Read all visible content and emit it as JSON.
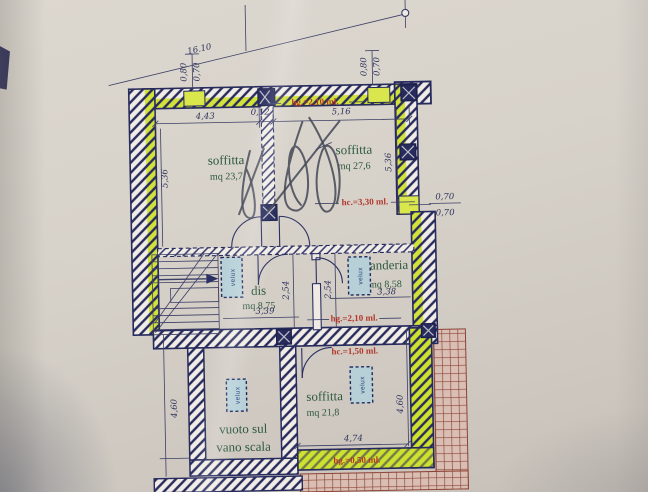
{
  "dims": {
    "overall": "16.10",
    "win_left": [
      "0,80",
      "0,70"
    ],
    "win_right": [
      "0,80",
      "0,70"
    ],
    "top_row": [
      "4,43",
      "0,12",
      "5,16"
    ],
    "left_height": "5,36",
    "right_height": "5,36",
    "right_step": [
      "0,70",
      "0,70"
    ],
    "mid_heights": [
      "2,54",
      "2,54"
    ],
    "dis_width": "3,39",
    "lav_width": "3,38",
    "bottom_left_height": "4,60",
    "bottom_right_height": "4,60",
    "bottom_width": "4,74"
  },
  "rooms": {
    "soffitta_nw": {
      "name": "soffitta",
      "area": "mq 23,7"
    },
    "soffitta_ne": {
      "name": "soffitta",
      "area": "mq 27,6"
    },
    "dis": {
      "name": "dis",
      "area": "mq 8,75"
    },
    "lavanderia": {
      "name": "lavanderia",
      "area": "mq 8,58"
    },
    "soffitta_s": {
      "name": "soffitta",
      "area": "mq 21,8"
    },
    "vuoto_scala": {
      "line1": "vuoto sul",
      "line2": "vano scala"
    }
  },
  "heights": {
    "hg_top": "hg.=2,10 ml.",
    "hc_top": "hc.=3,30 ml.",
    "hg_mid": "hg.=2,10 ml.",
    "hc_mid": "hc.=1,50 ml.",
    "hg_bottom": "hg.=0,50 ml."
  },
  "labels": {
    "velux": "velux"
  },
  "colors": {
    "wall_ink": "#262a5c",
    "highlight_green": "#d3e23b",
    "annotation_red": "#b3372b",
    "room_text_green": "#2e5940",
    "roof_grid_red": "#8f4236",
    "paper": "#d6d0c8"
  }
}
